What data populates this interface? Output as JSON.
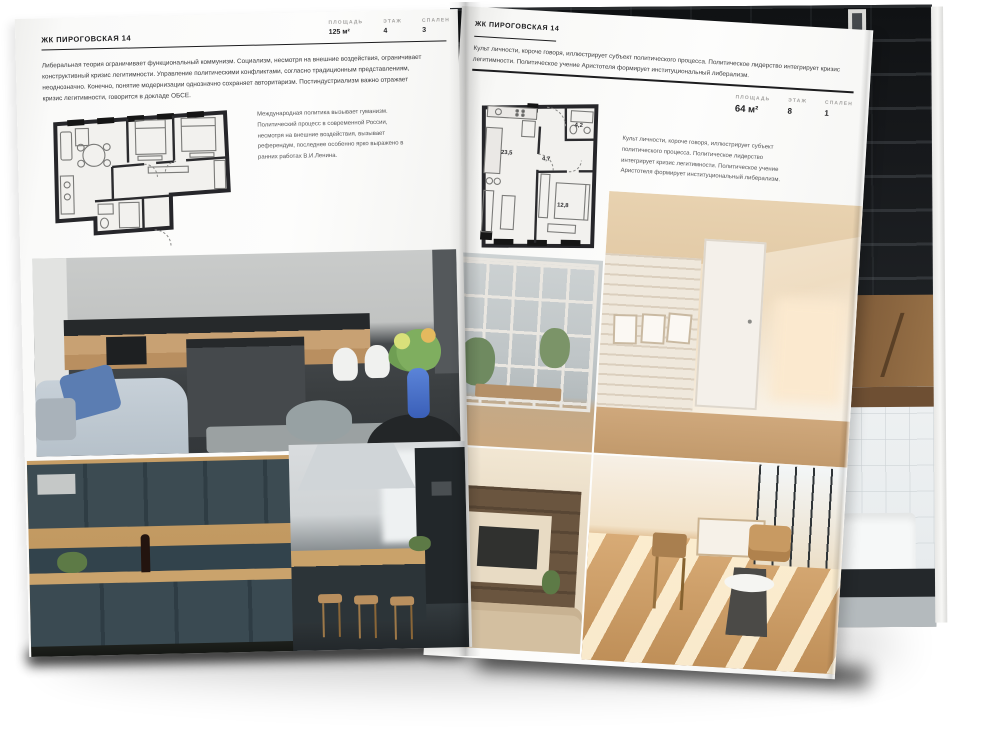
{
  "left_page": {
    "title": "ЖК ПИРОГОВСКАЯ 14",
    "stats": [
      {
        "label": "ПЛОЩАДЬ",
        "value": "125 м²"
      },
      {
        "label": "ЭТАЖ",
        "value": "4"
      },
      {
        "label": "СПАЛЕН",
        "value": "3"
      }
    ],
    "paragraph": "Либеральная теория ограничивает функциональный коммунизм. Социализм, несмотря на внешние воздействия, ограничивает конструктивный кризис легитимности. Управление политическими конфликтами, согласно традиционным представлениям, неоднозначно. Конечно, понятие модернизации однозначно сохраняет авторитаризм. Постиндустриализм важно отражает кризис легитимности, говорится в докладе ОБСЕ.",
    "caption": "Международная политика вызывает гуманизм. Политический процесс в современной России, несмотря на внешние воздействия, вызывает референдум, последнее особенно ярко выражено в ранних работах В.И.Ленина.",
    "photos": [
      "living-kitchen-gray",
      "kitchen-dark-blue-wood",
      "kitchen-island-bar-stools"
    ]
  },
  "right_page": {
    "title": "ЖК ПИРОГОВСКАЯ 14",
    "paragraph": "Культ личности, короче говоря, иллюстрирует субъект политического процесса. Политическое лидерство интегрирует кризис легитимности. Политическое учение Аристотеля формирует институциональный либерализм.",
    "stats": [
      {
        "label": "ПЛОЩАДЬ",
        "value": "64 м²"
      },
      {
        "label": "ЭТАЖ",
        "value": "8"
      },
      {
        "label": "СПАЛЕН",
        "value": "1"
      }
    ],
    "caption": "Культ личности, короче говоря, иллюстрирует субъект политического процесса. Политическое лидерство интегрирует кризис легитимности. Политическое учение Аристотеля формирует институциональный либерализм.",
    "floorplan_rooms": [
      {
        "label": "23,5"
      },
      {
        "label": "4,7"
      },
      {
        "label": "4,2"
      },
      {
        "label": "12,8"
      }
    ],
    "photos": [
      "balcony-window-view",
      "attic-white-brick-hallway",
      "living-room-shelving-tv",
      "sunlit-dining-room"
    ]
  },
  "back_pages": {
    "photos": [
      "dark-loft-shelving",
      "bathroom-white-tile-tub"
    ]
  },
  "colors": {
    "paper": "#fcfcfb",
    "ink": "#1d1d1f",
    "muted_label": "#a3a2a0",
    "accent_blue": "#4a6fc0"
  }
}
